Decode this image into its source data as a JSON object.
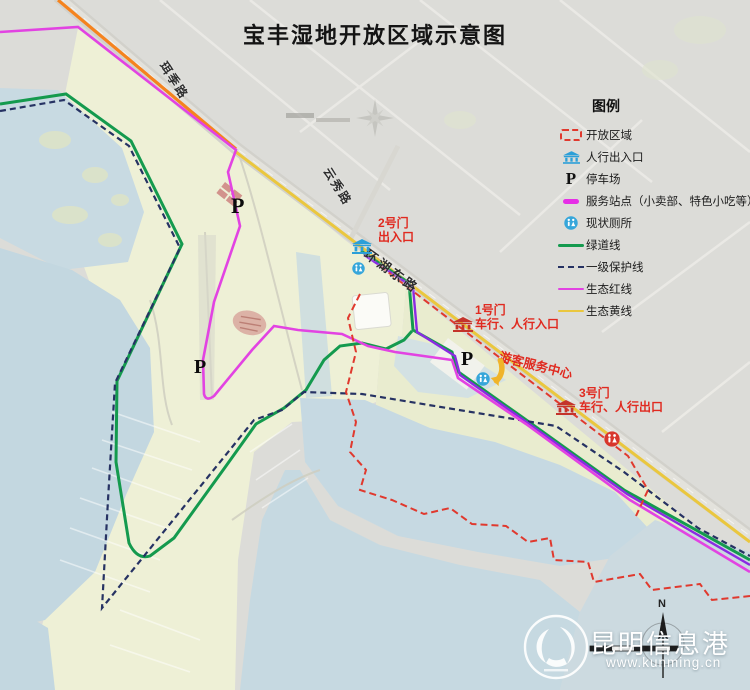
{
  "title": "宝丰湿地开放区域示意图",
  "legend": {
    "title": "图例",
    "items": [
      {
        "label": "开放区域",
        "swatch": "open-area-dashed-box",
        "color": "#e0392e"
      },
      {
        "label": "人行出入口",
        "swatch": "gate-icon",
        "color": "#2b9fd8"
      },
      {
        "label": "停车场",
        "swatch": "parking-symbol",
        "symbol": "P"
      },
      {
        "label": "服务站点（小卖部、特色小吃等）",
        "swatch": "service-point-line",
        "color": "#e62ee6"
      },
      {
        "label": "现状厕所",
        "swatch": "toilet-icon",
        "color": "#36a6da"
      },
      {
        "label": "绿道线",
        "swatch": "solid-line",
        "color": "#149a4e"
      },
      {
        "label": "一级保护线",
        "swatch": "dashed-line",
        "color": "#263263"
      },
      {
        "label": "生态红线",
        "swatch": "solid-line",
        "color": "#e243e2"
      },
      {
        "label": "生态黄线",
        "swatch": "solid-line",
        "color": "#eac73e"
      }
    ]
  },
  "roads": [
    {
      "name": "珥季路"
    },
    {
      "name": "云秀路"
    },
    {
      "name": "环湖东路"
    }
  ],
  "gates": [
    {
      "line1": "2号门",
      "line2": "出入口",
      "icon_color": "#2b9fd8"
    },
    {
      "line1": "1号门",
      "line2": "车行、人行入口",
      "icon_color": "#c4342b"
    },
    {
      "line1": "3号门",
      "line2": "车行、人行出口",
      "icon_color": "#c4342b"
    }
  ],
  "labels": {
    "visitor_center": "游客服务中心",
    "parking_symbol": "P",
    "north": "N"
  },
  "watermark": {
    "name": "昆明信息港",
    "url": "www.kunming.cn"
  },
  "colors": {
    "road_orange": "#f5831e",
    "eco_yellow": "#eac73e",
    "eco_red_magenta": "#e243e2",
    "greenway_green": "#149a4e",
    "protection_navy": "#263263",
    "open_area_red": "#e0392e",
    "corridor_purple": "#8a2be2",
    "gate_red": "#c4342b",
    "gate_blue": "#2b9fd8",
    "label_red": "#e02a20",
    "water": "#c8dae2",
    "wetland": "#eef0d6"
  }
}
